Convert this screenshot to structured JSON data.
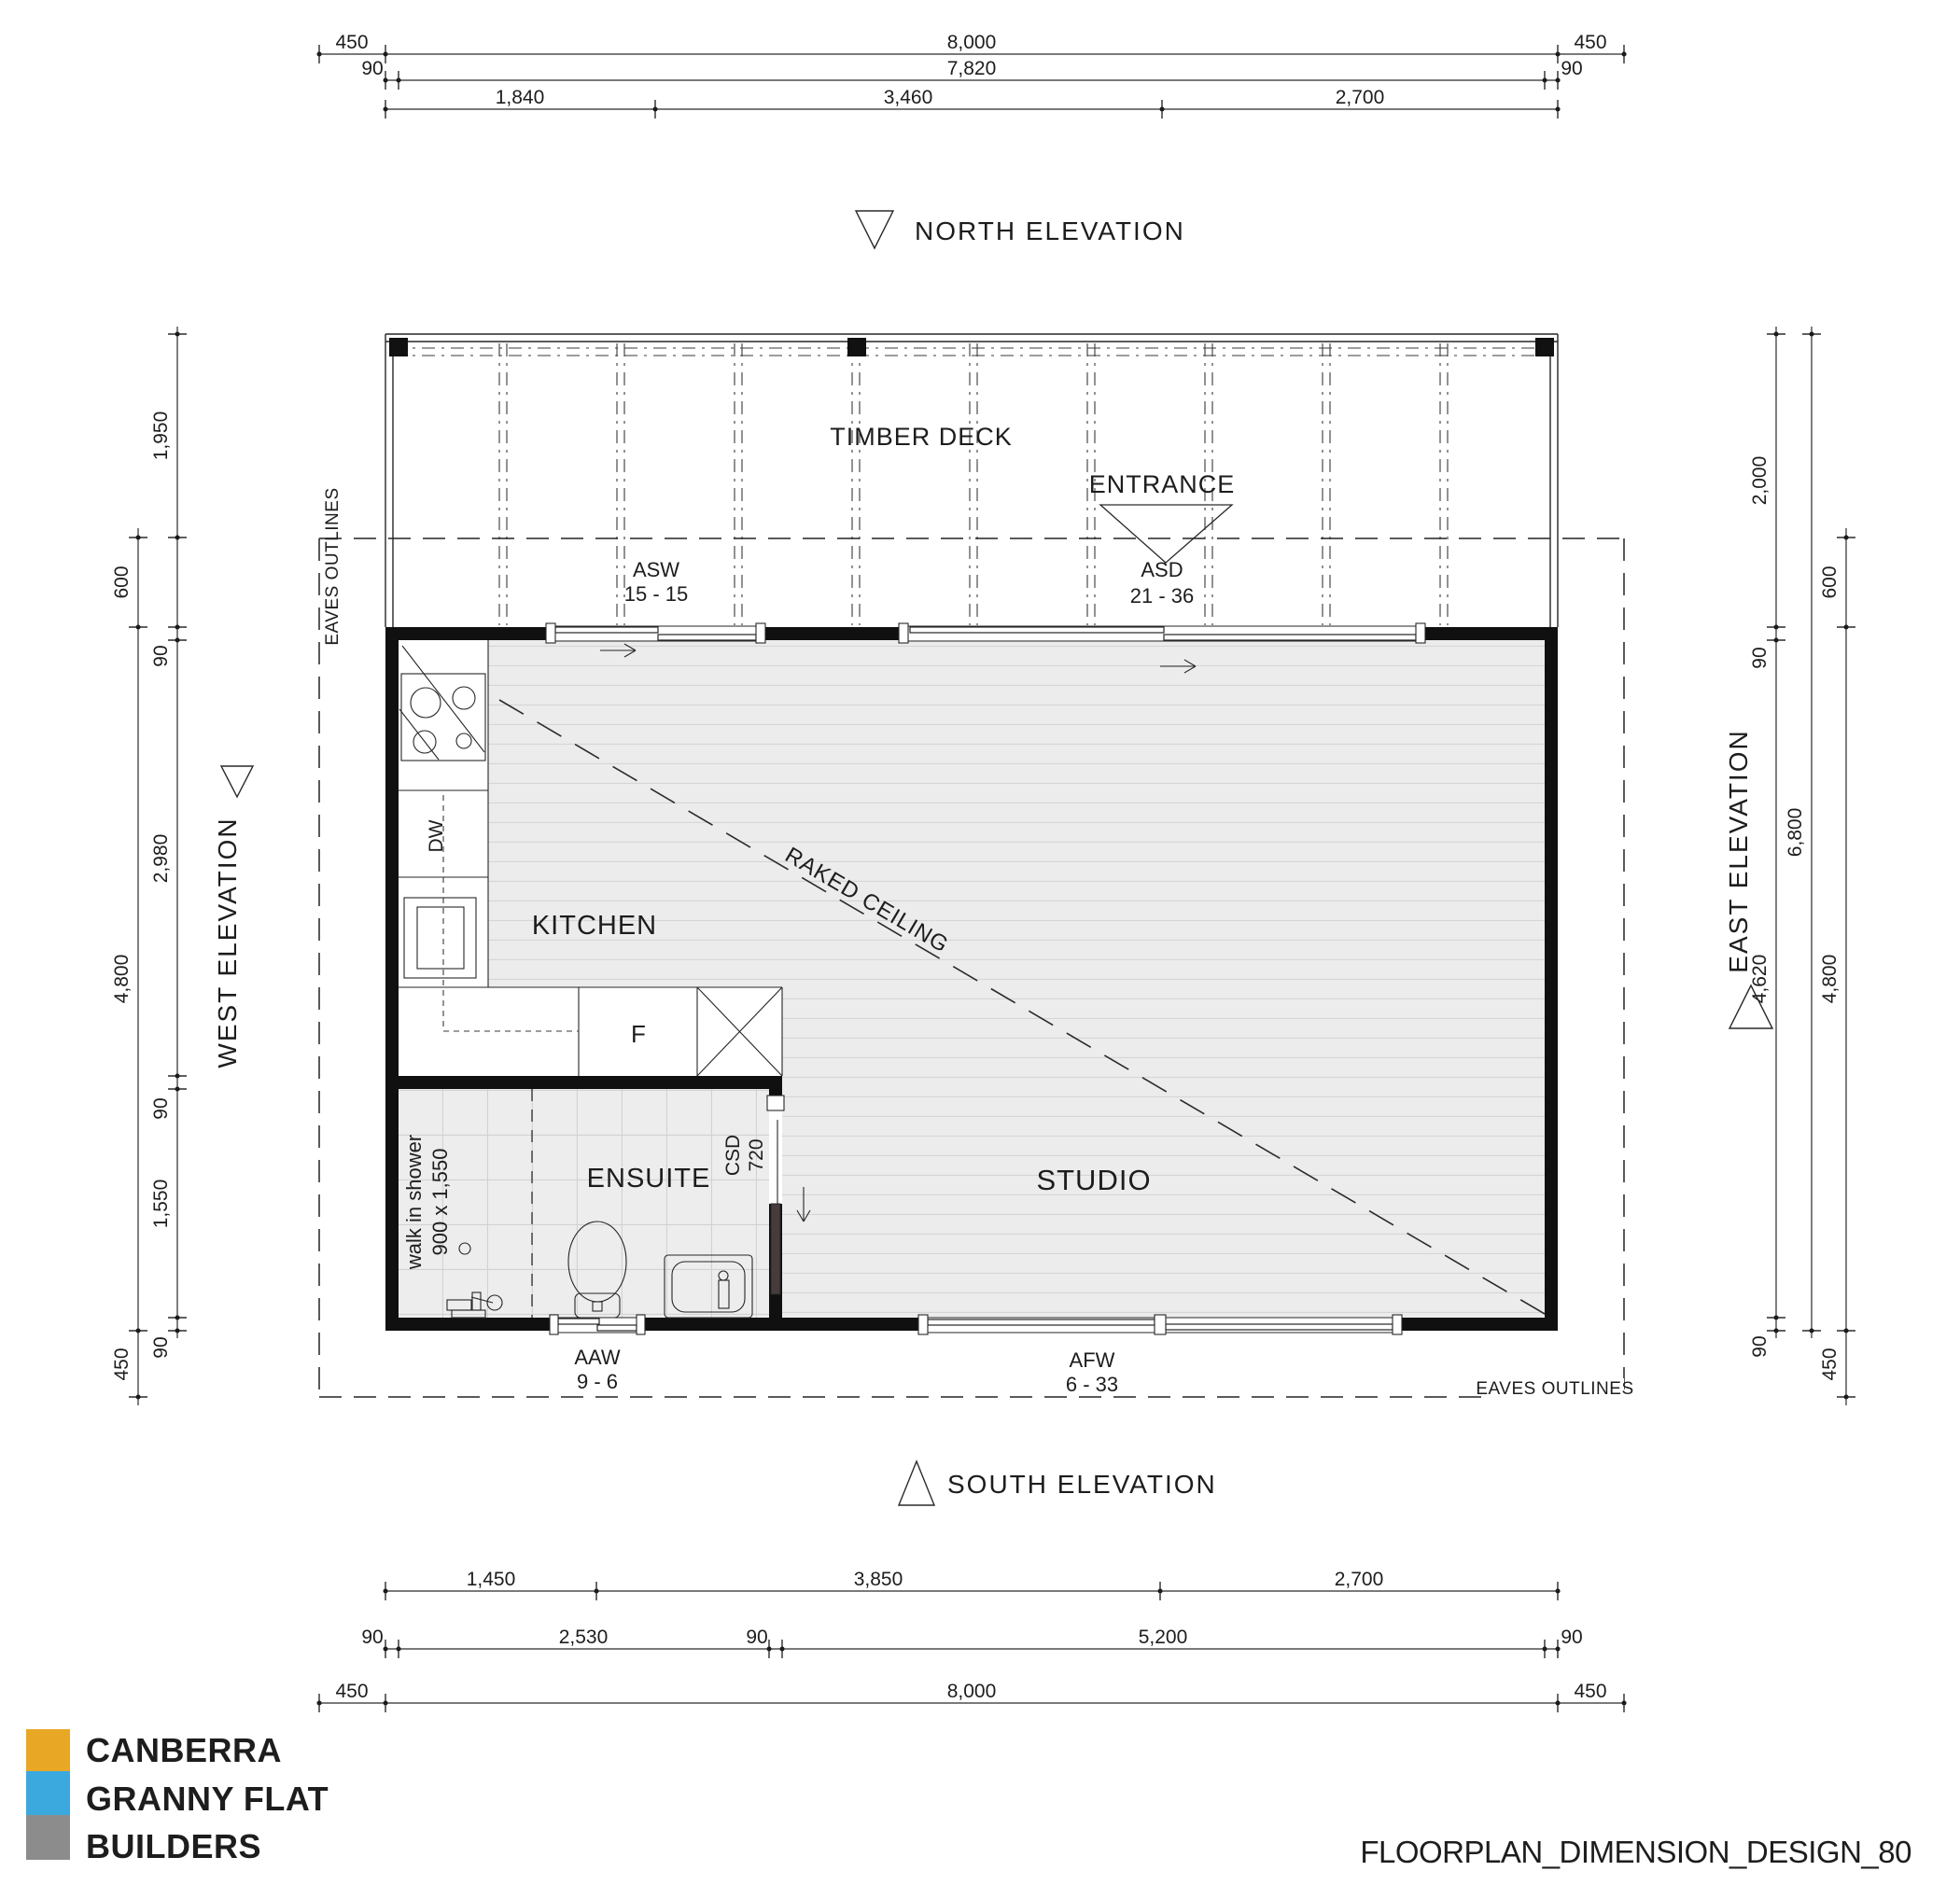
{
  "title": "FLOORPLAN_DIMENSION_DESIGN_80",
  "logo": {
    "line1": "CANBERRA",
    "line2": "GRANNY FLAT",
    "line3": "BUILDERS",
    "color_gold": "#DFA32B",
    "color_blue": "#41A8DB",
    "color_gray": "#8C8C8C"
  },
  "elevation_labels": {
    "north": "NORTH ELEVATION",
    "south": "SOUTH ELEVATION",
    "east": "EAST ELEVATION",
    "west": "WEST ELEVATION"
  },
  "room_labels": {
    "kitchen": "KITCHEN",
    "ensuite": "ENSUITE",
    "studio": "STUDIO",
    "deck": "TIMBER DECK",
    "entrance": "ENTRANCE"
  },
  "annotations": {
    "raked_ceiling": "RAKED CEILING",
    "eaves_outlines_left": "EAVES OUTLINES",
    "eaves_outlines_bottom": "EAVES OUTLINES",
    "walk_in_shower_line1": "walk in shower",
    "walk_in_shower_line2": "900 x 1,550",
    "dishwasher": "DW",
    "fridge": "F"
  },
  "openings": {
    "asw": {
      "code": "ASW",
      "size": "15 - 15"
    },
    "asd": {
      "code": "ASD",
      "size": "21 - 36"
    },
    "aaw": {
      "code": "AAW",
      "size": "9 - 6"
    },
    "afw": {
      "code": "AFW",
      "size": "6 - 33"
    },
    "csd": {
      "code": "CSD",
      "size": "720"
    }
  },
  "dimensions": {
    "top_row1": {
      "left": "450",
      "mid": "8,000",
      "right": "450"
    },
    "top_row2": {
      "left": "90",
      "mid": "7,820",
      "right": "90"
    },
    "top_row3": {
      "a": "1,840",
      "b": "3,460",
      "c": "2,700"
    },
    "bottom_row1": {
      "a": "1,450",
      "b": "3,850",
      "c": "2,700"
    },
    "bottom_row2": {
      "a": "90",
      "b": "2,530",
      "c": "90",
      "d": "5,200",
      "e": "90"
    },
    "bottom_row3": {
      "left": "450",
      "mid": "8,000",
      "right": "450"
    },
    "west_inner": {
      "a": "1,950",
      "b": "90",
      "c": "2,980",
      "d": "90",
      "e": "1,550",
      "f": "90"
    },
    "west_outer": {
      "a": "600",
      "b": "4,800",
      "c": "450"
    },
    "east_inner": {
      "a": "2,000",
      "b": "90",
      "c": "4,620",
      "d": "90"
    },
    "east_mid": {
      "a": "6,800"
    },
    "east_outer": {
      "a": "600",
      "b": "4,800",
      "c": "450"
    }
  }
}
